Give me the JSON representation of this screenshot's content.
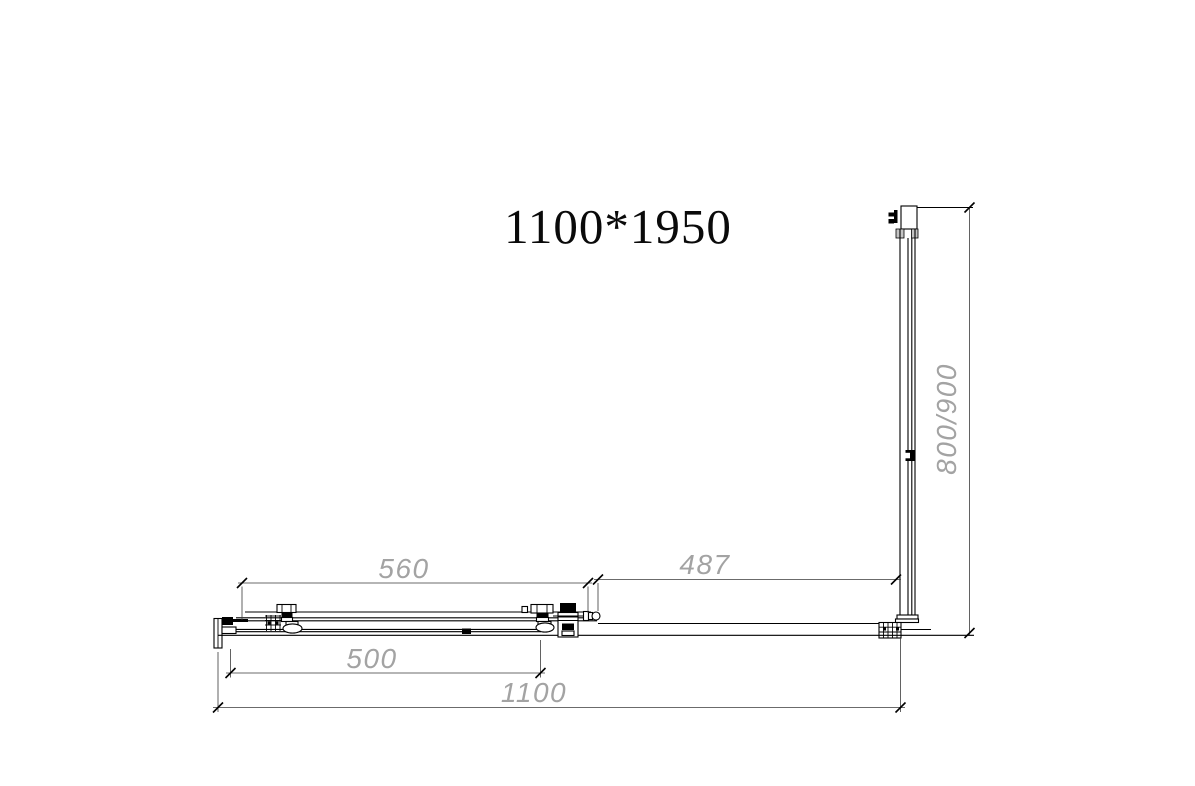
{
  "title": "1100*1950",
  "colors": {
    "line": "#000000",
    "dim_line": "#3a3a3a",
    "dimension_text": "#a3a3a3",
    "shading": "#c4c4c4",
    "background": "#ffffff"
  },
  "dimensions": {
    "door_track_width": {
      "label": "560"
    },
    "fixed_panel_width": {
      "label": "487"
    },
    "door_glass_width": {
      "label": "500"
    },
    "total_width": {
      "label": "1100"
    },
    "side_panel_depth": {
      "label": "800/900"
    }
  }
}
